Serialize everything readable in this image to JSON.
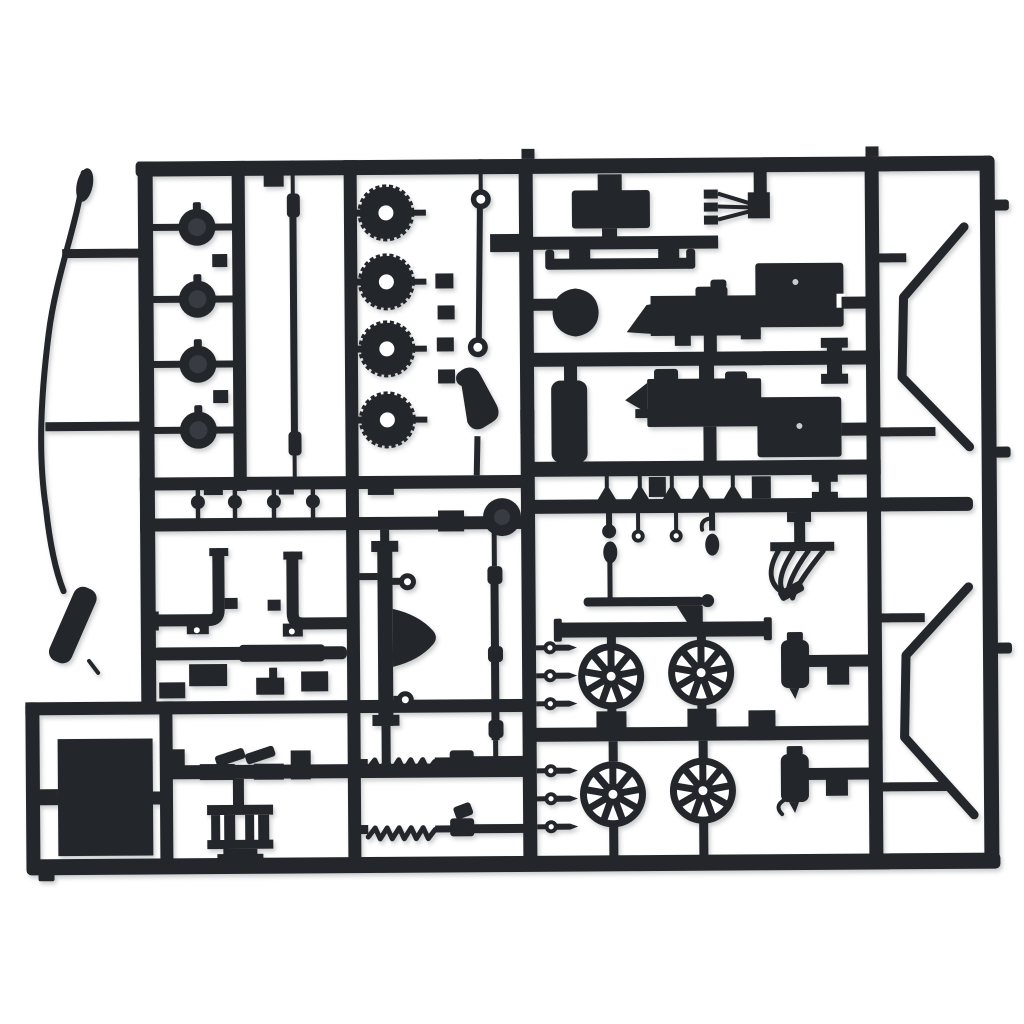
{
  "photo": {
    "subject": "Black plastic model kit sprue (parts tree) with unassembled scale car parts",
    "description": "Top-down product photo of a dark charcoal injection-moulded sprue on a plain white background. The rectangular runner frame holds chassis, engine and wheel parts for a scale model car.",
    "aria_label": "Black plastic model car kit sprue on white background"
  },
  "palette": {
    "background": "#ffffff",
    "plastic": "#23262b",
    "plastic_soft": "#383c42",
    "hole": "#ffffff",
    "ejector_mark": "#c9ccd1",
    "shadow": "rgba(25,28,33,0.22)"
  },
  "parts": [
    {
      "id": "flexible-wire",
      "label": "Flexible wire with pod tip",
      "count": 1
    },
    {
      "id": "muffler",
      "label": "Angled muffler cylinder",
      "count": 1
    },
    {
      "id": "dome-caps",
      "label": "Dome caps",
      "count": 4
    },
    {
      "id": "torsion-rod",
      "label": "Long torsion rod with couplers",
      "count": 1
    },
    {
      "id": "ribbed-drums",
      "label": "Ribbed drums with centre hole",
      "count": 4
    },
    {
      "id": "tie-rod",
      "label": "Tie rod with eyelet ends",
      "count": 1
    },
    {
      "id": "steering-knuckle",
      "label": "Bent knuckle arm with ball",
      "count": 1
    },
    {
      "id": "radiator",
      "label": "Radiator block",
      "count": 1
    },
    {
      "id": "sled-bar",
      "label": "Running board with upturned tips",
      "count": 1
    },
    {
      "id": "ignition-wiring",
      "label": "Three-prong wiring harness",
      "count": 1
    },
    {
      "id": "engine-halves",
      "label": "Engine block halves with supercharger nose",
      "count": 2
    },
    {
      "id": "bell-housing",
      "label": "Bell housing dome",
      "count": 1
    },
    {
      "id": "fuel-tank",
      "label": "Upright fuel tank",
      "count": 1
    },
    {
      "id": "i-beam-brackets",
      "label": "I-beam brackets",
      "count": 2
    },
    {
      "id": "spade-pins",
      "label": "Spade-head pins",
      "count": 5
    },
    {
      "id": "ball-pins",
      "label": "Ball-centre pins",
      "count": 4
    },
    {
      "id": "eyelet-dumbbells",
      "label": "Eyelet dumbbell pins",
      "count": 2
    },
    {
      "id": "kingpin",
      "label": "Kingpin with teardrop tip",
      "count": 1
    },
    {
      "id": "distributor",
      "label": "Ball-head distributor stem",
      "count": 1
    },
    {
      "id": "exhaust-headers",
      "label": "Fanned exhaust header pipes",
      "count": 1
    },
    {
      "id": "radius-rods",
      "label": "Radius rods",
      "count": 2
    },
    {
      "id": "spoked-wheels",
      "label": "Nine-spoke wheels",
      "count": 4
    },
    {
      "id": "cylindrical-tanks",
      "label": "Cylindrical tanks with mounting arms",
      "count": 2
    },
    {
      "id": "nerf-bars",
      "label": "Bent nerf-bar rods",
      "count": 2
    },
    {
      "id": "rear-axle",
      "label": "Rear axle beam with differential",
      "count": 1
    },
    {
      "id": "driveshaft",
      "label": "Driveshaft with couplers",
      "count": 1
    },
    {
      "id": "brake-drum",
      "label": "Brake drum disc",
      "count": 1
    },
    {
      "id": "l-pipes",
      "label": "L-shaped exhaust pipes",
      "count": 2
    },
    {
      "id": "cross-bar",
      "label": "Tapered cross bar",
      "count": 1
    },
    {
      "id": "floor-panel",
      "label": "Flat floor panel",
      "count": 1
    },
    {
      "id": "channel-posts",
      "label": "Twin channel-post bracket",
      "count": 1
    },
    {
      "id": "coil-shocks",
      "label": "Coil-spring shock absorbers",
      "count": 2
    },
    {
      "id": "valve-pins",
      "label": "Valve-stem pins with eyelets",
      "count": 6
    }
  ]
}
